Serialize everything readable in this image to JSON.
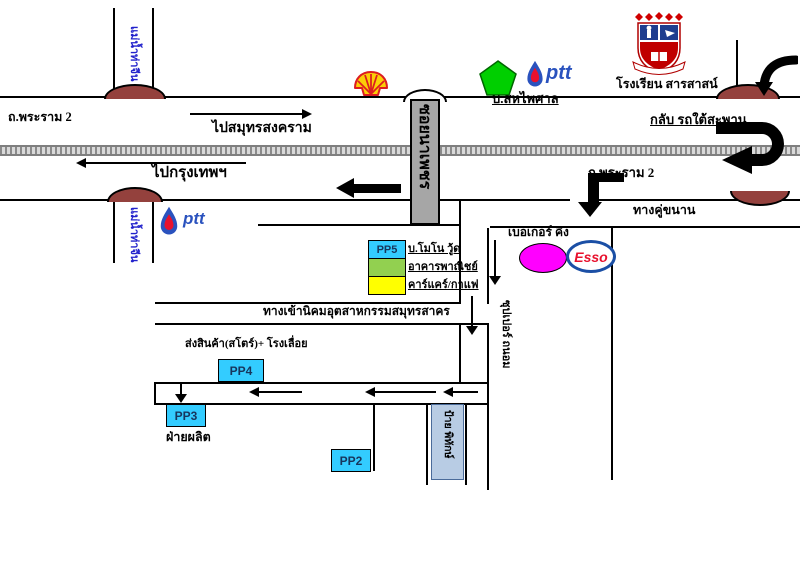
{
  "labels": {
    "rama2_left": "ถ.พระราม 2",
    "to_samut_songkhram": "ไปสมุทรสงคราม",
    "to_bangkok": "ไปกรุงเทพฯ",
    "uturn_under_bridge": "กลับ รถใต้สะพาน",
    "rama2_right": "ถ.พระราม 2",
    "parallel_road": "ทางคู่ขนาน",
    "river": "แม่น้ำท่าจีน",
    "soi_sign": "ซอยนาเพชร",
    "saha_phaisan": "บ.สหไพศาล",
    "school": "โรงเรียน สารสาสน์",
    "ptt": "ptt",
    "esso": "Esso",
    "burger_king": "เบอเกอร์ คิง",
    "estate_entrance": "ทางเข้านิคมอุตสาหกรรมสมุทรสาคร",
    "store_sawmill": "ส่งสินค้า(สโตร์)+ โรงเลื่อย",
    "production_dept": "ฝ่ายผลิต",
    "super_thanom": "ซุปเปอร์ ถนอม",
    "sign_board": "ป้าย พิทักษ์"
  },
  "legend": {
    "items": [
      {
        "code": "PP5",
        "label": "บ.โมโน วู้ด",
        "color": "#33CCFF"
      },
      {
        "code": "",
        "label": "อาคารพาณิชย์",
        "color": "#92D050"
      },
      {
        "code": "",
        "label": "คาร์แคร์/กาแฟ",
        "color": "#FFFF00"
      }
    ]
  },
  "buildings": {
    "pp2": "PP2",
    "pp3": "PP3",
    "pp4": "PP4"
  },
  "colors": {
    "building_cyan": "#33CCFF",
    "legend_green": "#92D050",
    "legend_yellow": "#FFFF00",
    "burger_king_magenta": "#FF00FF",
    "bridge_brown": "#94413D",
    "soi_bar_gray": "#A6A6A6",
    "sign_box_blue": "#B8CCE4",
    "river_text_blue": "#2222CC",
    "ptt_blue": "#2A52BE",
    "ptt_red": "#E8112D",
    "esso_blue": "#1B4FA5",
    "esso_red": "#E8112D",
    "shell_yellow": "#FBCE07",
    "shell_red": "#DD1D21",
    "pentagon_green": "#00CF00"
  }
}
